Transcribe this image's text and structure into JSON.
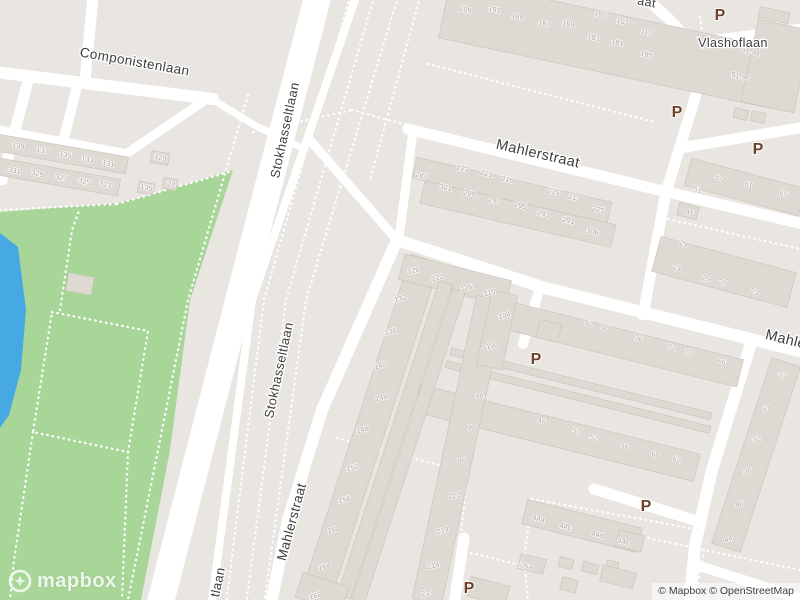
{
  "canvas": {
    "width": 800,
    "height": 600
  },
  "colors": {
    "background": "#e9e6e2",
    "road": "#ffffff",
    "park": "#a8d598",
    "water": "#47a9e3",
    "building_fill": "#ded9d2",
    "building_stroke": "#cbc5bc",
    "street_label": "#3d3d3d",
    "house_number": "#a9a39b",
    "parking": "#6d4228",
    "path": "#ffffff"
  },
  "logo": {
    "text": "mapbox"
  },
  "attribution": {
    "text": "© Mapbox © OpenStreetMap"
  },
  "parking": {
    "label": "P",
    "positions": [
      [
        720,
        20
      ],
      [
        677,
        117
      ],
      [
        758,
        154
      ],
      [
        536,
        364
      ],
      [
        646,
        511
      ],
      [
        469,
        593
      ]
    ]
  },
  "streets": [
    {
      "text": "Componistenlaan",
      "x": 134,
      "y": 66,
      "rot": 10,
      "size": 13.5
    },
    {
      "text": "Stokhasseltlaan",
      "x": 289,
      "y": 131,
      "rot": -78,
      "size": 13
    },
    {
      "text": "Stokhasseltlaan",
      "x": 283,
      "y": 371,
      "rot": -78,
      "size": 13
    },
    {
      "text": "Mahlerstraat",
      "x": 537,
      "y": 158,
      "rot": 13,
      "size": 14.5
    },
    {
      "text": "Mahlerstraat",
      "x": 296,
      "y": 523,
      "rot": -75,
      "size": 13.5
    },
    {
      "text": "Mahlerstraat",
      "x": 806,
      "y": 349,
      "rot": 14,
      "size": 14.5
    },
    {
      "text": "Vlashoflaan",
      "x": 733,
      "y": 47,
      "rot": 0,
      "size": 12.5
    },
    {
      "text": "aat",
      "x": 646,
      "y": 6,
      "rot": 10,
      "size": 12.5
    },
    {
      "text": "tlaan",
      "x": 222,
      "y": 583,
      "rot": -78,
      "size": 13
    }
  ],
  "house_numbers": [
    [
      "139",
      18,
      148,
      10
    ],
    [
      "137",
      42,
      153,
      10
    ],
    [
      "135",
      65,
      157,
      10
    ],
    [
      "133",
      87,
      162,
      10
    ],
    [
      "131",
      108,
      166,
      10
    ],
    [
      "331",
      14,
      173,
      10
    ],
    [
      "329",
      37,
      176,
      10
    ],
    [
      "327",
      61,
      180,
      10
    ],
    [
      "325",
      84,
      184,
      10
    ],
    [
      "323",
      105,
      187,
      10
    ],
    [
      "129",
      160,
      160,
      10
    ],
    [
      "135",
      146,
      190,
      10
    ],
    [
      "28",
      171,
      186,
      10
    ],
    [
      "209",
      465,
      12,
      12
    ],
    [
      "191",
      494,
      12,
      12
    ],
    [
      "189",
      517,
      19,
      12
    ],
    [
      "187",
      544,
      26,
      12
    ],
    [
      "169",
      568,
      26,
      12
    ],
    [
      "105",
      600,
      17,
      12
    ],
    [
      "103",
      622,
      24,
      12
    ],
    [
      "115",
      646,
      35,
      12
    ],
    [
      "183",
      593,
      40,
      12
    ],
    [
      "181",
      617,
      45,
      12
    ],
    [
      "195",
      646,
      57,
      12
    ],
    [
      "91-94",
      750,
      54,
      14
    ],
    [
      "91-96",
      740,
      79,
      14
    ],
    [
      "287",
      421,
      178,
      13
    ],
    [
      "223",
      462,
      171,
      13
    ],
    [
      "221",
      486,
      176,
      13
    ],
    [
      "219",
      507,
      182,
      13
    ],
    [
      "215",
      553,
      194,
      13
    ],
    [
      "213",
      574,
      200,
      13
    ],
    [
      "301",
      445,
      190,
      13
    ],
    [
      "299",
      469,
      196,
      13
    ],
    [
      "297",
      494,
      203,
      13
    ],
    [
      "295",
      520,
      208,
      13
    ],
    [
      "293",
      543,
      216,
      13
    ],
    [
      "291",
      568,
      223,
      13
    ],
    [
      "225",
      598,
      212,
      13
    ],
    [
      "306",
      592,
      234,
      13
    ],
    [
      "57",
      718,
      180,
      15
    ],
    [
      "61",
      748,
      187,
      15
    ],
    [
      "65",
      783,
      196,
      15
    ],
    [
      "51",
      697,
      192,
      15
    ],
    [
      "45",
      689,
      215,
      15
    ],
    [
      "29",
      683,
      246,
      15
    ],
    [
      "23",
      676,
      270,
      15
    ],
    [
      "29",
      706,
      281,
      15
    ],
    [
      "27",
      722,
      285,
      15
    ],
    [
      "23",
      754,
      294,
      15
    ],
    [
      "22",
      783,
      377,
      -15
    ],
    [
      "28",
      768,
      410,
      -15
    ],
    [
      "32",
      757,
      441,
      -15
    ],
    [
      "36",
      748,
      473,
      -15
    ],
    [
      "40",
      740,
      506,
      -15
    ],
    [
      "44",
      729,
      541,
      -15
    ],
    [
      "92",
      588,
      326,
      15
    ],
    [
      "90",
      604,
      331,
      15
    ],
    [
      "76",
      638,
      341,
      15
    ],
    [
      "72",
      671,
      350,
      15
    ],
    [
      "70",
      688,
      355,
      15
    ],
    [
      "66",
      721,
      364,
      15
    ],
    [
      "46",
      541,
      424,
      15
    ],
    [
      "50",
      576,
      434,
      15
    ],
    [
      "52",
      593,
      440,
      15
    ],
    [
      "56",
      624,
      449,
      15
    ],
    [
      "60",
      655,
      457,
      15
    ],
    [
      "62",
      676,
      462,
      15
    ],
    [
      "128",
      414,
      273,
      -14
    ],
    [
      "132",
      401,
      301,
      -14
    ],
    [
      "136",
      391,
      334,
      -14
    ],
    [
      "140",
      381,
      368,
      -14
    ],
    [
      "144",
      382,
      400,
      -14
    ],
    [
      "148",
      363,
      432,
      -14
    ],
    [
      "152",
      353,
      470,
      -14
    ],
    [
      "156",
      345,
      502,
      -14
    ],
    [
      "160",
      334,
      532,
      -14
    ],
    [
      "164",
      325,
      569,
      -14
    ],
    [
      "168",
      316,
      598,
      -14
    ],
    [
      "122",
      438,
      280,
      -14
    ],
    [
      "116",
      467,
      290,
      -14
    ],
    [
      "110",
      490,
      295,
      -14
    ],
    [
      "104",
      505,
      318,
      -14
    ],
    [
      "100",
      493,
      348,
      -14
    ],
    [
      "94",
      480,
      398,
      -14
    ],
    [
      "90",
      472,
      430,
      -14
    ],
    [
      "86",
      462,
      463,
      -14
    ],
    [
      "222",
      455,
      498,
      -14
    ],
    [
      "219",
      443,
      533,
      -14
    ],
    [
      "214",
      434,
      568,
      -14
    ],
    [
      "210",
      428,
      595,
      -14
    ],
    [
      "44a",
      538,
      521,
      14
    ],
    [
      "44c",
      565,
      529,
      14
    ],
    [
      "44d",
      597,
      537,
      14
    ],
    [
      "44e",
      623,
      544,
      14
    ],
    [
      "226a",
      524,
      568,
      14
    ]
  ],
  "areas": {
    "park": {
      "points": [
        [
          0,
          212
        ],
        [
          117,
          203
        ],
        [
          150,
          195
        ],
        [
          233,
          170
        ],
        [
          190,
          300
        ],
        [
          170,
          450
        ],
        [
          141,
          600
        ],
        [
          0,
          600
        ]
      ]
    },
    "water": {
      "points": [
        [
          0,
          233
        ],
        [
          18,
          247
        ],
        [
          26,
          310
        ],
        [
          21,
          370
        ],
        [
          9,
          415
        ],
        [
          0,
          428
        ]
      ]
    }
  },
  "roads": [
    {
      "p": [
        [
          -5,
          72
        ],
        [
          213,
          99
        ]
      ],
      "w": 12
    },
    {
      "p": [
        [
          210,
          98
        ],
        [
          256,
          126
        ],
        [
          302,
          148
        ]
      ],
      "w": 7
    },
    {
      "p": [
        [
          93,
          -3
        ],
        [
          85,
          81
        ]
      ],
      "w": 11
    },
    {
      "p": [
        [
          78,
          83
        ],
        [
          63,
          142
        ]
      ],
      "w": 10
    },
    {
      "p": [
        [
          29,
          77
        ],
        [
          2,
          180
        ]
      ],
      "w": 11
    },
    {
      "p": [
        [
          -4,
          130
        ],
        [
          126,
          154
        ]
      ],
      "w": 10
    },
    {
      "p": [
        [
          126,
          154
        ],
        [
          207,
          99
        ]
      ],
      "w": 9
    },
    {
      "p": [
        [
          319,
          -8
        ],
        [
          240,
          295
        ],
        [
          159,
          608
        ]
      ],
      "w": 27
    },
    {
      "p": [
        [
          357,
          -6
        ],
        [
          252,
          300
        ],
        [
          211,
          608
        ]
      ],
      "w": 8
    },
    {
      "p": [
        [
          408,
          129
        ],
        [
          663,
          191
        ],
        [
          803,
          224
        ]
      ],
      "w": 11
    },
    {
      "p": [
        [
          641,
          -6
        ],
        [
          668,
          18
        ],
        [
          693,
          45
        ],
        [
          701,
          78
        ],
        [
          666,
          192
        ],
        [
          643,
          315
        ]
      ],
      "w": 11
    },
    {
      "p": [
        [
          699,
          42
        ],
        [
          805,
          28
        ]
      ],
      "w": 10
    },
    {
      "p": [
        [
          680,
          148
        ],
        [
          805,
          127
        ]
      ],
      "w": 11
    },
    {
      "p": [
        [
          308,
          138
        ],
        [
          397,
          240
        ]
      ],
      "w": 9
    },
    {
      "p": [
        [
          413,
          131
        ],
        [
          399,
          238
        ]
      ],
      "w": 9
    },
    {
      "p": [
        [
          397,
          240
        ],
        [
          322,
          410
        ],
        [
          288,
          520
        ],
        [
          270,
          608
        ]
      ],
      "w": 12
    },
    {
      "p": [
        [
          397,
          240
        ],
        [
          545,
          288
        ],
        [
          803,
          352
        ]
      ],
      "w": 12
    },
    {
      "p": [
        [
          538,
          294
        ],
        [
          523,
          344
        ]
      ],
      "w": 10
    },
    {
      "p": [
        [
          752,
          340
        ],
        [
          712,
          470
        ],
        [
          695,
          545
        ],
        [
          689,
          608
        ]
      ],
      "w": 12
    },
    {
      "p": [
        [
          594,
          489
        ],
        [
          697,
          521
        ]
      ],
      "w": 11
    },
    {
      "p": [
        [
          700,
          566
        ],
        [
          805,
          600
        ]
      ],
      "w": 10
    },
    {
      "p": [
        [
          464,
          538
        ],
        [
          454,
          605
        ]
      ],
      "w": 11
    }
  ],
  "paths": [
    {
      "p": [
        [
          350,
          -3
        ],
        [
          264,
          300
        ],
        [
          226,
          605
        ]
      ]
    },
    {
      "p": [
        [
          374,
          -3
        ],
        [
          286,
          300
        ],
        [
          246,
          605
        ]
      ]
    },
    {
      "p": [
        [
          398,
          -3
        ],
        [
          306,
          300
        ],
        [
          264,
          605
        ]
      ]
    },
    {
      "p": [
        [
          420,
          -3
        ],
        [
          370,
          180
        ]
      ]
    },
    {
      "p": [
        [
          248,
          95
        ],
        [
          188,
          300
        ],
        [
          128,
          600
        ]
      ]
    },
    {
      "p": [
        [
          253,
          132
        ],
        [
          352,
          110
        ]
      ]
    },
    {
      "p": [
        [
          352,
          110
        ],
        [
          425,
          130
        ]
      ]
    },
    {
      "p": [
        [
          0,
          210
        ],
        [
          117,
          204
        ]
      ]
    },
    {
      "p": [
        [
          117,
          204
        ],
        [
          233,
          171
        ]
      ]
    },
    {
      "p": [
        [
          52,
          312
        ],
        [
          148,
          331
        ],
        [
          128,
          452
        ],
        [
          33,
          432
        ],
        [
          52,
          312
        ]
      ]
    },
    {
      "p": [
        [
          60,
          310
        ],
        [
          72,
          230
        ],
        [
          80,
          208
        ]
      ]
    },
    {
      "p": [
        [
          33,
          432
        ],
        [
          14,
          560
        ],
        [
          10,
          600
        ]
      ]
    },
    {
      "p": [
        [
          128,
          452
        ],
        [
          122,
          600
        ]
      ]
    },
    {
      "p": [
        [
          428,
          64
        ],
        [
          655,
          122
        ]
      ]
    },
    {
      "p": [
        [
          700,
          17
        ],
        [
          706,
          58
        ]
      ]
    },
    {
      "p": [
        [
          757,
          30
        ],
        [
          763,
          92
        ]
      ]
    },
    {
      "p": [
        [
          663,
          218
        ],
        [
          800,
          249
        ]
      ]
    },
    {
      "p": [
        [
          532,
          499
        ],
        [
          700,
          530
        ],
        [
          692,
          600
        ]
      ]
    },
    {
      "p": [
        [
          532,
          499
        ],
        [
          524,
          560
        ],
        [
          528,
          600
        ]
      ]
    },
    {
      "p": [
        [
          337,
          438
        ],
        [
          468,
          473
        ],
        [
          459,
          550
        ],
        [
          520,
          565
        ]
      ]
    },
    {
      "p": [
        [
          600,
          528
        ],
        [
          800,
          570
        ]
      ]
    },
    {
      "p": [
        [
          704,
          550
        ],
        [
          694,
          605
        ]
      ]
    }
  ],
  "buildings": [
    {
      "cx": 62,
      "cy": 154,
      "w": 132,
      "h": 17,
      "rot": 10
    },
    {
      "cx": 58,
      "cy": 177,
      "w": 124,
      "h": 17,
      "rot": 10
    },
    {
      "cx": 160,
      "cy": 158,
      "w": 18,
      "h": 12,
      "rot": 10
    },
    {
      "cx": 146,
      "cy": 188,
      "w": 16,
      "h": 11,
      "rot": 10
    },
    {
      "cx": 170,
      "cy": 184,
      "w": 14,
      "h": 11,
      "rot": 10
    },
    {
      "cx": 80,
      "cy": 284,
      "w": 26,
      "h": 18,
      "rot": 10
    },
    {
      "cx": 612,
      "cy": 44,
      "w": 342,
      "h": 60,
      "rot": 12
    },
    {
      "cx": 776,
      "cy": 66,
      "w": 54,
      "h": 84,
      "rot": 12
    },
    {
      "cx": 741,
      "cy": 114,
      "w": 14,
      "h": 10,
      "rot": 12
    },
    {
      "cx": 758,
      "cy": 117,
      "w": 14,
      "h": 10,
      "rot": 12
    },
    {
      "cx": 774,
      "cy": 15,
      "w": 30,
      "h": 11,
      "rot": 12
    },
    {
      "cx": 512,
      "cy": 190,
      "w": 200,
      "h": 21,
      "rot": 13
    },
    {
      "cx": 518,
      "cy": 214,
      "w": 196,
      "h": 23,
      "rot": 13
    },
    {
      "cx": 745,
      "cy": 187,
      "w": 118,
      "h": 28,
      "rot": 15
    },
    {
      "cx": 688,
      "cy": 211,
      "w": 20,
      "h": 13,
      "rot": 15
    },
    {
      "cx": 724,
      "cy": 272,
      "w": 140,
      "h": 36,
      "rot": 15
    },
    {
      "cx": 756,
      "cy": 455,
      "w": 30,
      "h": 195,
      "rot": 18
    },
    {
      "cx": 610,
      "cy": 341,
      "w": 268,
      "h": 28,
      "rot": 14
    },
    {
      "cx": 549,
      "cy": 331,
      "w": 22,
      "h": 18,
      "rot": 14
    },
    {
      "cx": 581,
      "cy": 384,
      "w": 268,
      "h": 7,
      "rot": 14
    },
    {
      "cx": 578,
      "cy": 397,
      "w": 272,
      "h": 7,
      "rot": 14
    },
    {
      "cx": 557,
      "cy": 433,
      "w": 288,
      "h": 28,
      "rot": 14
    },
    {
      "cx": 370,
      "cy": 430,
      "w": 30,
      "h": 360,
      "rot": 18
    },
    {
      "cx": 455,
      "cy": 280,
      "w": 110,
      "h": 26,
      "rot": 14
    },
    {
      "cx": 395,
      "cy": 440,
      "w": 14,
      "h": 330,
      "rot": 18
    },
    {
      "cx": 408,
      "cy": 448,
      "w": 13,
      "h": 330,
      "rot": 18
    },
    {
      "cx": 459,
      "cy": 450,
      "w": 30,
      "h": 310,
      "rot": 12
    },
    {
      "cx": 497,
      "cy": 330,
      "w": 26,
      "h": 76,
      "rot": 12
    },
    {
      "cx": 582,
      "cy": 526,
      "w": 118,
      "h": 25,
      "rot": 14
    },
    {
      "cx": 532,
      "cy": 564,
      "w": 26,
      "h": 15,
      "rot": 14
    },
    {
      "cx": 566,
      "cy": 563,
      "w": 14,
      "h": 10,
      "rot": 14
    },
    {
      "cx": 590,
      "cy": 568,
      "w": 16,
      "h": 10,
      "rot": 14
    },
    {
      "cx": 569,
      "cy": 585,
      "w": 16,
      "h": 13,
      "rot": 14
    },
    {
      "cx": 612,
      "cy": 566,
      "w": 12,
      "h": 10,
      "rot": 14
    },
    {
      "cx": 630,
      "cy": 541,
      "w": 26,
      "h": 17,
      "rot": 14
    },
    {
      "cx": 618,
      "cy": 577,
      "w": 34,
      "h": 16,
      "rot": 14
    },
    {
      "cx": 322,
      "cy": 592,
      "w": 48,
      "h": 26,
      "rot": 18
    },
    {
      "cx": 488,
      "cy": 591,
      "w": 40,
      "h": 20,
      "rot": 14
    }
  ]
}
